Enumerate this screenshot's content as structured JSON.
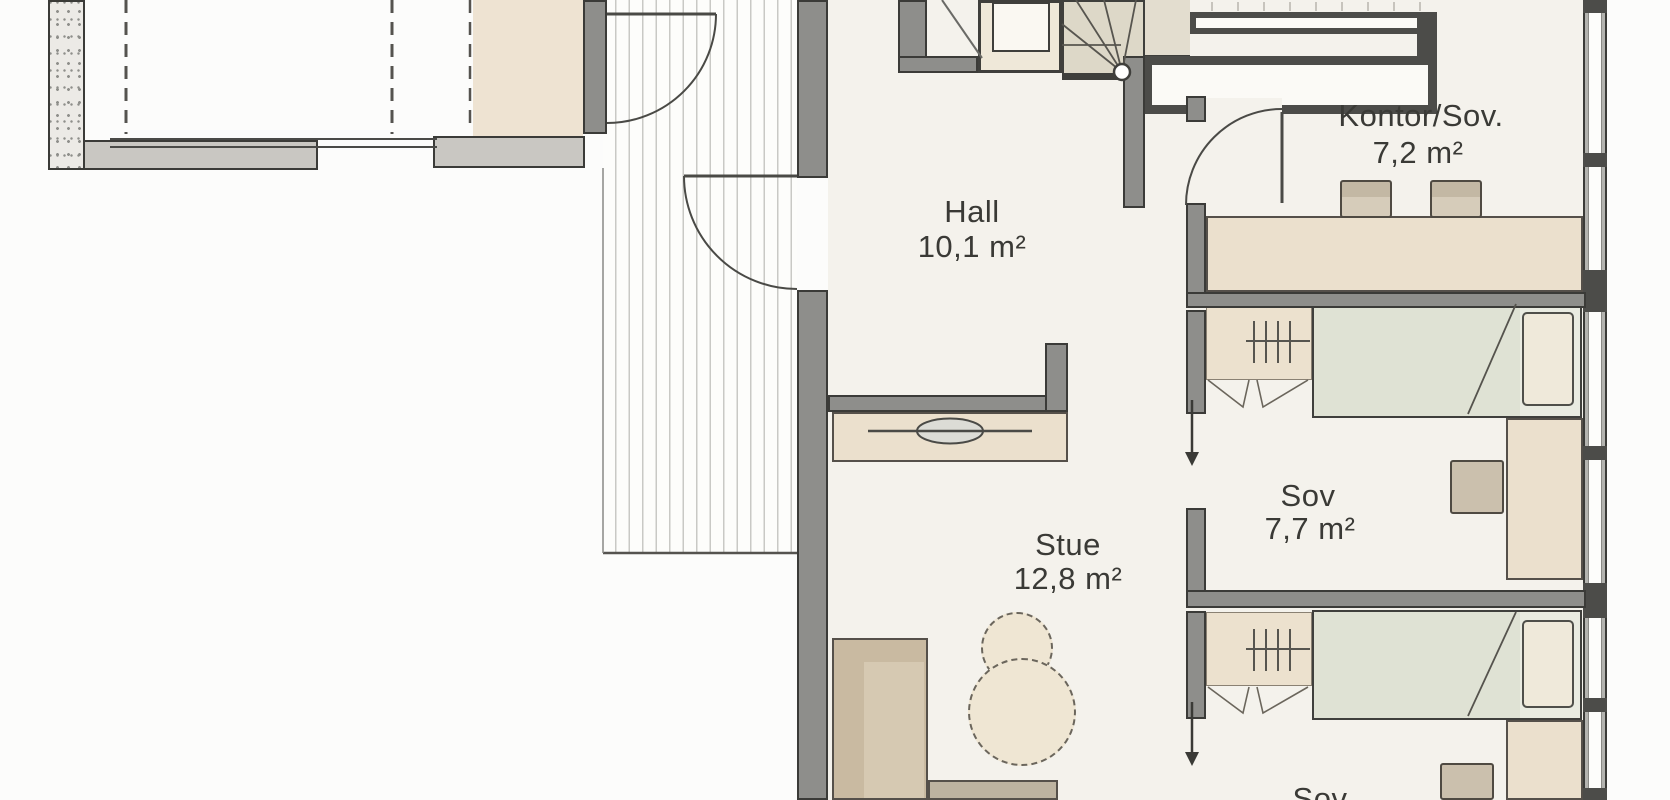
{
  "rooms": [
    {
      "id": "hall",
      "name": "Hall",
      "area": "10,1 m²"
    },
    {
      "id": "kontor",
      "name": "Kontor/Sov.",
      "area": "7,2 m²"
    },
    {
      "id": "sov1",
      "name": "Sov",
      "area": "7,7 m²"
    },
    {
      "id": "stue",
      "name": "Stue",
      "area": "12,8 m²"
    },
    {
      "id": "sov2",
      "name": "Sov",
      "area": ""
    }
  ],
  "colors": {
    "wall": "#8e8e8b",
    "wall_dark": "#4c4c49",
    "floor": "#f4f2ec",
    "furniture": "#ebe0cd",
    "bed_blanket": "#dfe2d4",
    "text": "#3a3a36"
  }
}
